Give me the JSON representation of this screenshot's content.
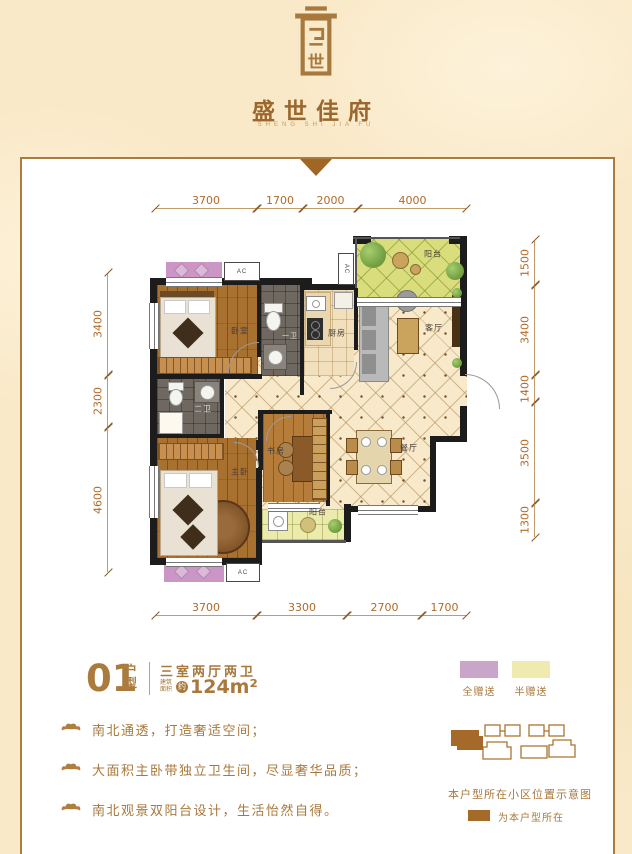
{
  "brand": {
    "name": "盛世佳府",
    "pinyin": "SHENG SHI JIA FU",
    "seal_char": "世"
  },
  "unit": {
    "number": "01",
    "type_label": "户型",
    "rooms_desc": "三室两厅两卫",
    "area_prefix": "建筑面积",
    "area_approx": "约",
    "area_value": "124m²"
  },
  "legend": {
    "items": [
      {
        "label": "全赠送",
        "color": "#c9a6c9"
      },
      {
        "label": "半赠送",
        "color": "#eeeab0"
      }
    ]
  },
  "features": {
    "items": [
      "南北通透，打造奢适空间；",
      "大面积主卧带独立卫生间，尽显奢华品质；",
      "南北观景双阳台设计，生活怡然自得。"
    ]
  },
  "site": {
    "caption": "本户型所在小区位置示意图",
    "legend_label": "为本户型所在",
    "highlight_color": "#a5692a"
  },
  "plan": {
    "ac_label": "AC",
    "rooms": {
      "bedroom": "卧室",
      "bath1": "一卫",
      "bath2": "二卫",
      "kitchen": "厨房",
      "living": "客厅",
      "dining": "餐厅",
      "study": "书房",
      "master": "主卧",
      "balcony_north": "阳台",
      "balcony_south": "阳台"
    },
    "dims": {
      "top": [
        "3700",
        "1700",
        "2000",
        "4000"
      ],
      "bottom": [
        "3700",
        "3300",
        "2700",
        "1700"
      ],
      "left": [
        "3400",
        "2300",
        "4600"
      ],
      "right": [
        "1500",
        "3400",
        "1400",
        "3500",
        "1300"
      ]
    }
  },
  "colors": {
    "accent_brown": "#a9783c",
    "brand_brown": "#9b672e",
    "triangle": "#a16524",
    "cream_bg": "#f9e9c8"
  }
}
